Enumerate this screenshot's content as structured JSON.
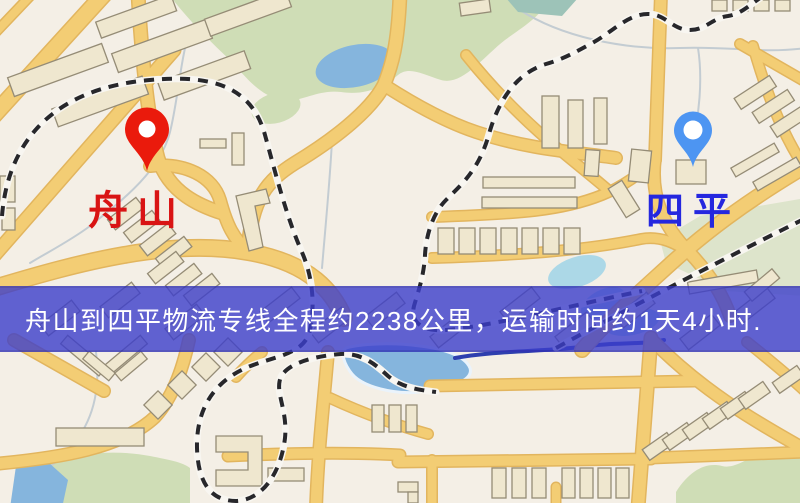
{
  "map": {
    "origin": {
      "label": "舟山"
    },
    "destination": {
      "label": "四平"
    },
    "banner": {
      "text": "舟山到四平物流专线全程约2238公里，运输时间约1天4小时."
    }
  },
  "icons": {
    "origin_pin": "map-pin",
    "destination_pin": "map-pin"
  },
  "colors": {
    "origin_pin": "#ea1a0c",
    "origin_label": "#d91414",
    "destination_pin": "#4d95f2",
    "destination_label": "#2527df",
    "banner_overlay": "#3c3ecb",
    "banner_text": "#ffffff",
    "map_background": "#f4efe6",
    "road": "#f3cd74",
    "road_casing": "#e2b55e",
    "park": "#cfddb6",
    "water": "#85b5dd",
    "railway": "#27272b",
    "building_fill": "#efe7cf",
    "building_stroke": "#958c76"
  }
}
